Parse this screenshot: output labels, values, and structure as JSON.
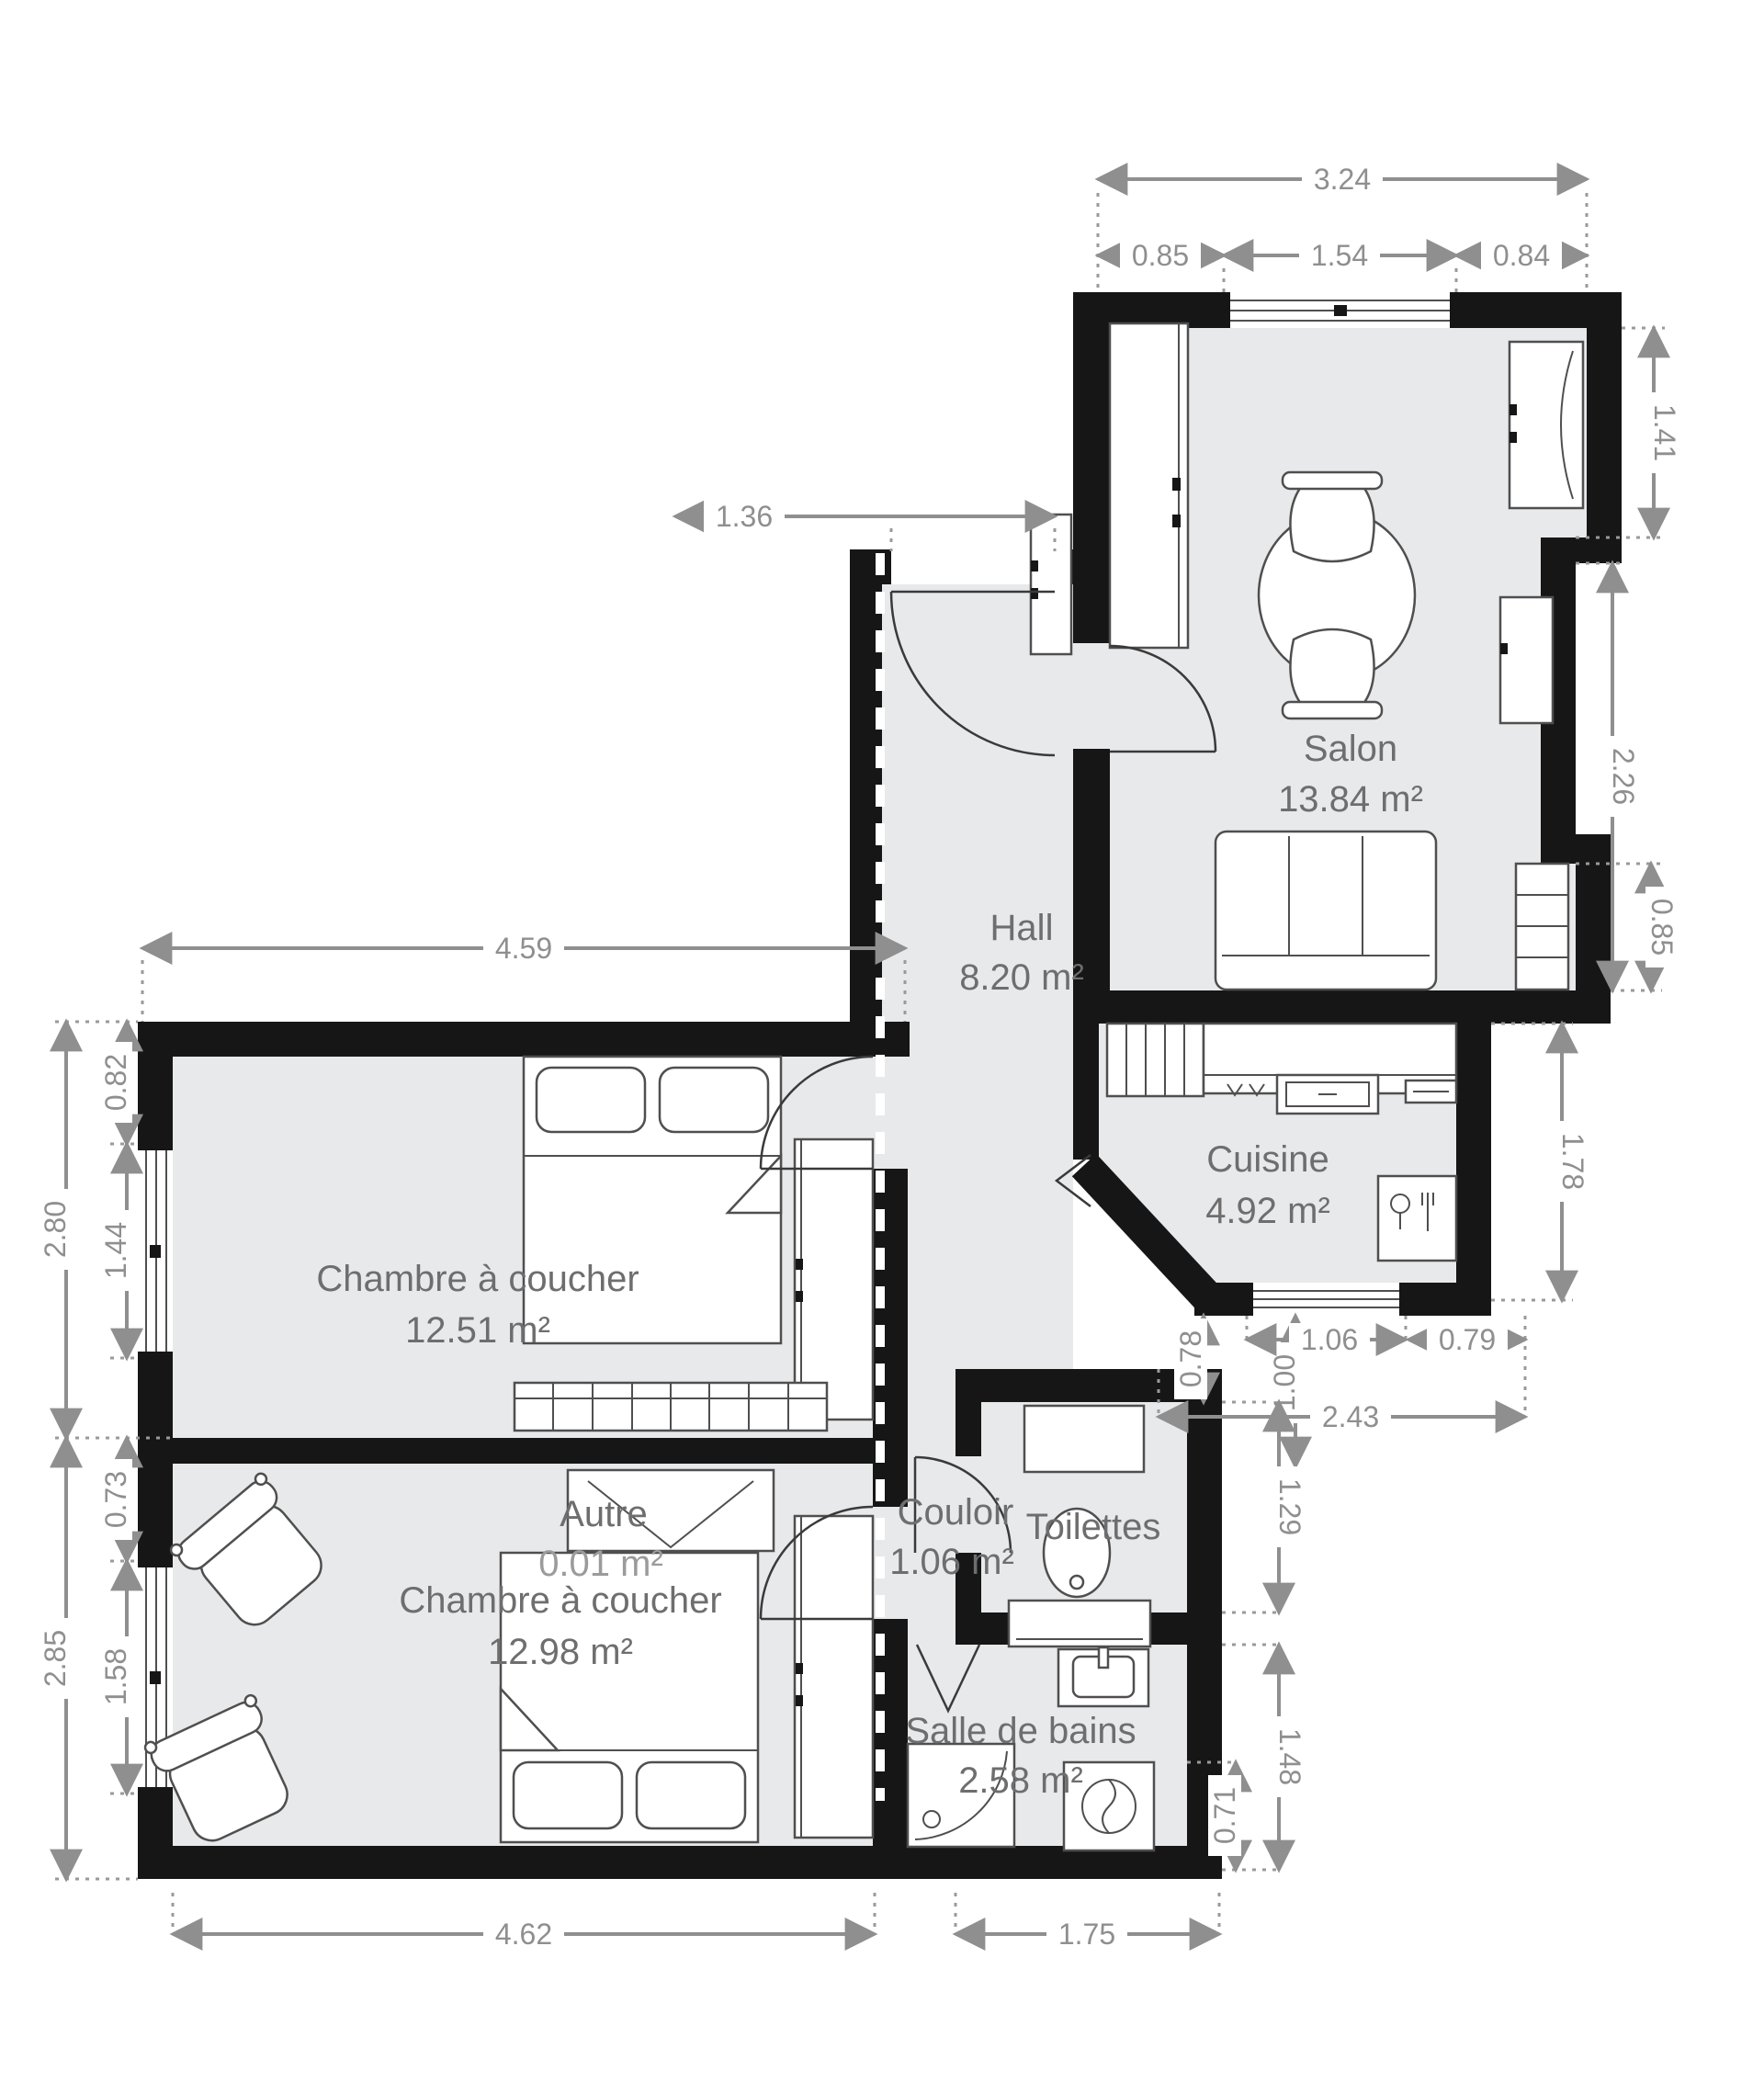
{
  "palette": {
    "wall": "#161616",
    "floor": "#e8e9eb",
    "dimension": "#8f8f8f",
    "room_text": "#6e6e6e",
    "muted_text": "#9b9b9b",
    "furniture_stroke": "#4f4f4f",
    "background": "#ffffff"
  },
  "rooms": [
    {
      "id": "salon",
      "name": "Salon",
      "area": "13.84 m²"
    },
    {
      "id": "hall",
      "name": "Hall",
      "area": "8.20 m²"
    },
    {
      "id": "cuisine",
      "name": "Cuisine",
      "area": "4.92 m²"
    },
    {
      "id": "chambre-1",
      "name": "Chambre à coucher",
      "area": "12.51 m²"
    },
    {
      "id": "autre",
      "name": "Autre",
      "area": "0.01 m²"
    },
    {
      "id": "chambre-2",
      "name": "Chambre à coucher",
      "area": "12.98 m²"
    },
    {
      "id": "couloir",
      "name": "Couloir",
      "area": "1.06 m²"
    },
    {
      "id": "toilettes",
      "name": "Toilettes",
      "area": ""
    },
    {
      "id": "salle-de-bains",
      "name": "Salle de bains",
      "area": "2.58 m²"
    }
  ],
  "dimensions": {
    "top_total": "3.24",
    "top_left": "0.85",
    "top_window": "1.54",
    "top_right": "0.84",
    "hall_entry": "1.36",
    "bedroom1_top": "4.59",
    "right_niche": "1.41",
    "right_mid": "2.26",
    "right_radiator": "0.85",
    "kitchen_right": "1.78",
    "left_upper_total": "2.80",
    "left_upper_wall": "0.82",
    "left_upper_window": "1.44",
    "left_lower_total": "2.85",
    "left_lower_wall": "0.73",
    "left_lower_window": "1.58",
    "mid_offset": "0.78",
    "mid_height": "1.00",
    "kitchen_window": "1.06",
    "mid_right": "0.79",
    "mid_total": "2.43",
    "toilettes_side": "1.29",
    "bath_side": "1.48",
    "bath_inner": "0.71",
    "bottom_bedroom": "4.62",
    "bottom_bath": "1.75"
  }
}
